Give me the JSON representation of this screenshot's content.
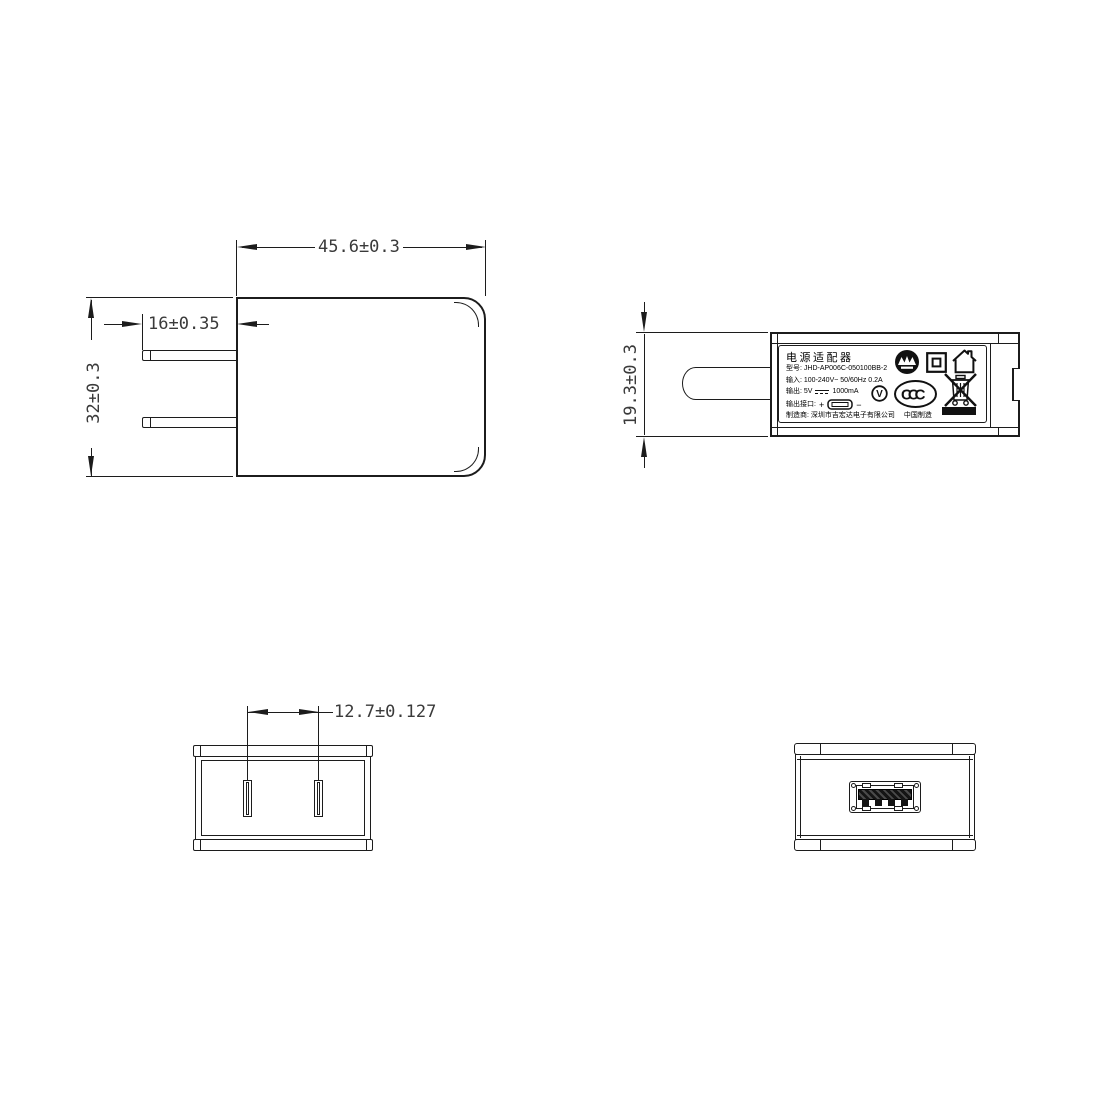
{
  "drawing": {
    "title": "Power adapter dimensional drawing",
    "line_color": "#1c1c1c",
    "front_view": {
      "dim_width": "45.6±0.3",
      "dim_prong_length": "16±0.35",
      "dim_height": "32±0.3"
    },
    "side_view": {
      "dim_thickness": "19.3±0.3",
      "label": {
        "title": "电源适配器",
        "model": "型号: JHD-AP006C-050100BB-2",
        "input": "输入: 100-240V~  50/60Hz  0.2A",
        "output_prefix": "输出: 5V",
        "output_current": "1000mA",
        "port_prefix": "输出接口:",
        "port_plus": "+",
        "port_minus": "−",
        "manufacturer": "制造商: 深圳市吉宏达电子有限公司",
        "made_in": "中国制造",
        "ccc_text": "CCC",
        "efficiency_text": "V"
      },
      "icons": [
        "certification-mark-icon",
        "double-insulation-icon",
        "indoor-use-icon",
        "efficiency-v-icon",
        "ccc-mark-icon",
        "weee-bin-icon"
      ]
    },
    "bottom_view": {
      "dim_pin_pitch": "12.7±0.127"
    },
    "rear_view": {
      "feature": "usb-a-port"
    }
  }
}
